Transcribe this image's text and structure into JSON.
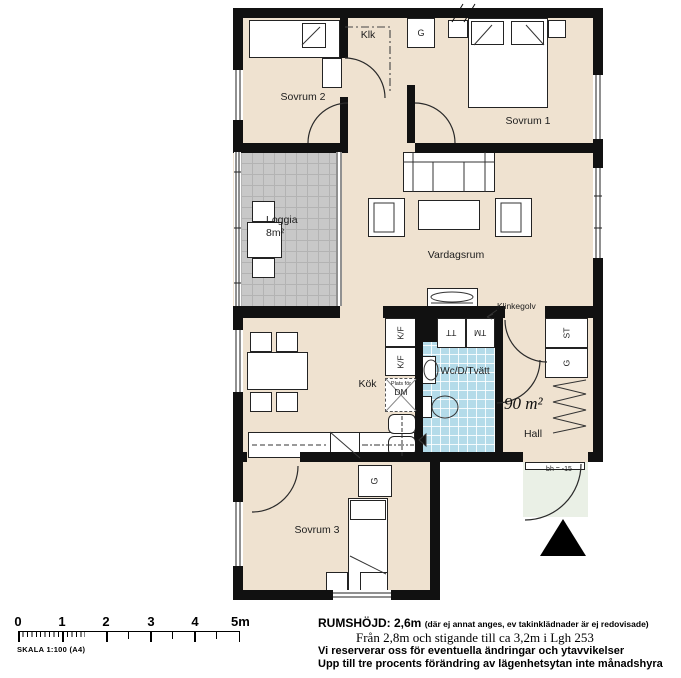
{
  "colors": {
    "wall": "#111111",
    "room_fill": "#efe2d0",
    "loggia_fill": "#c8c8c8",
    "wet_fill": "#b4dbe9",
    "entry_fill": "#eaf0e6"
  },
  "plan": {
    "rooms": {
      "sovrum2": "Sovrum 2",
      "sovrum1": "Sovrum 1",
      "sovrum3": "Sovrum 3",
      "klk": "Klk",
      "loggia_name": "Loggia",
      "loggia_area": "8m²",
      "vardagsrum": "Vardagsrum",
      "kok": "Kök",
      "wc": "Wc/D/Tvätt",
      "hall": "Hall",
      "apartment_area": "90 m²"
    },
    "fixtures": {
      "g": "G",
      "st": "ST",
      "kf": "K/F",
      "dm": "DM",
      "dm_caption": "Plats för",
      "tt": "TT",
      "tm": "TM"
    },
    "annotations": {
      "floor": "Klinkegolv",
      "sill_height": "bh = -15"
    }
  },
  "scale_bar": {
    "labels": [
      "0",
      "1",
      "2",
      "3",
      "4",
      "5m"
    ],
    "caption": "SKALA 1:100  (A4)"
  },
  "notes": {
    "rumshojd_bold": "RUMSHÖJD: 2,6m",
    "rumshojd_small": "(där ej annat anges, ev takinklädnader är ej redovisade)",
    "line2": "Från 2,8m och stigande till ca 3,2m i Lgh 253",
    "line3": "Vi reserverar oss för eventuella ändringar och ytavvikelser",
    "line4": "Upp till tre procents förändring av lägenhetsytan inte  månadshyra"
  }
}
